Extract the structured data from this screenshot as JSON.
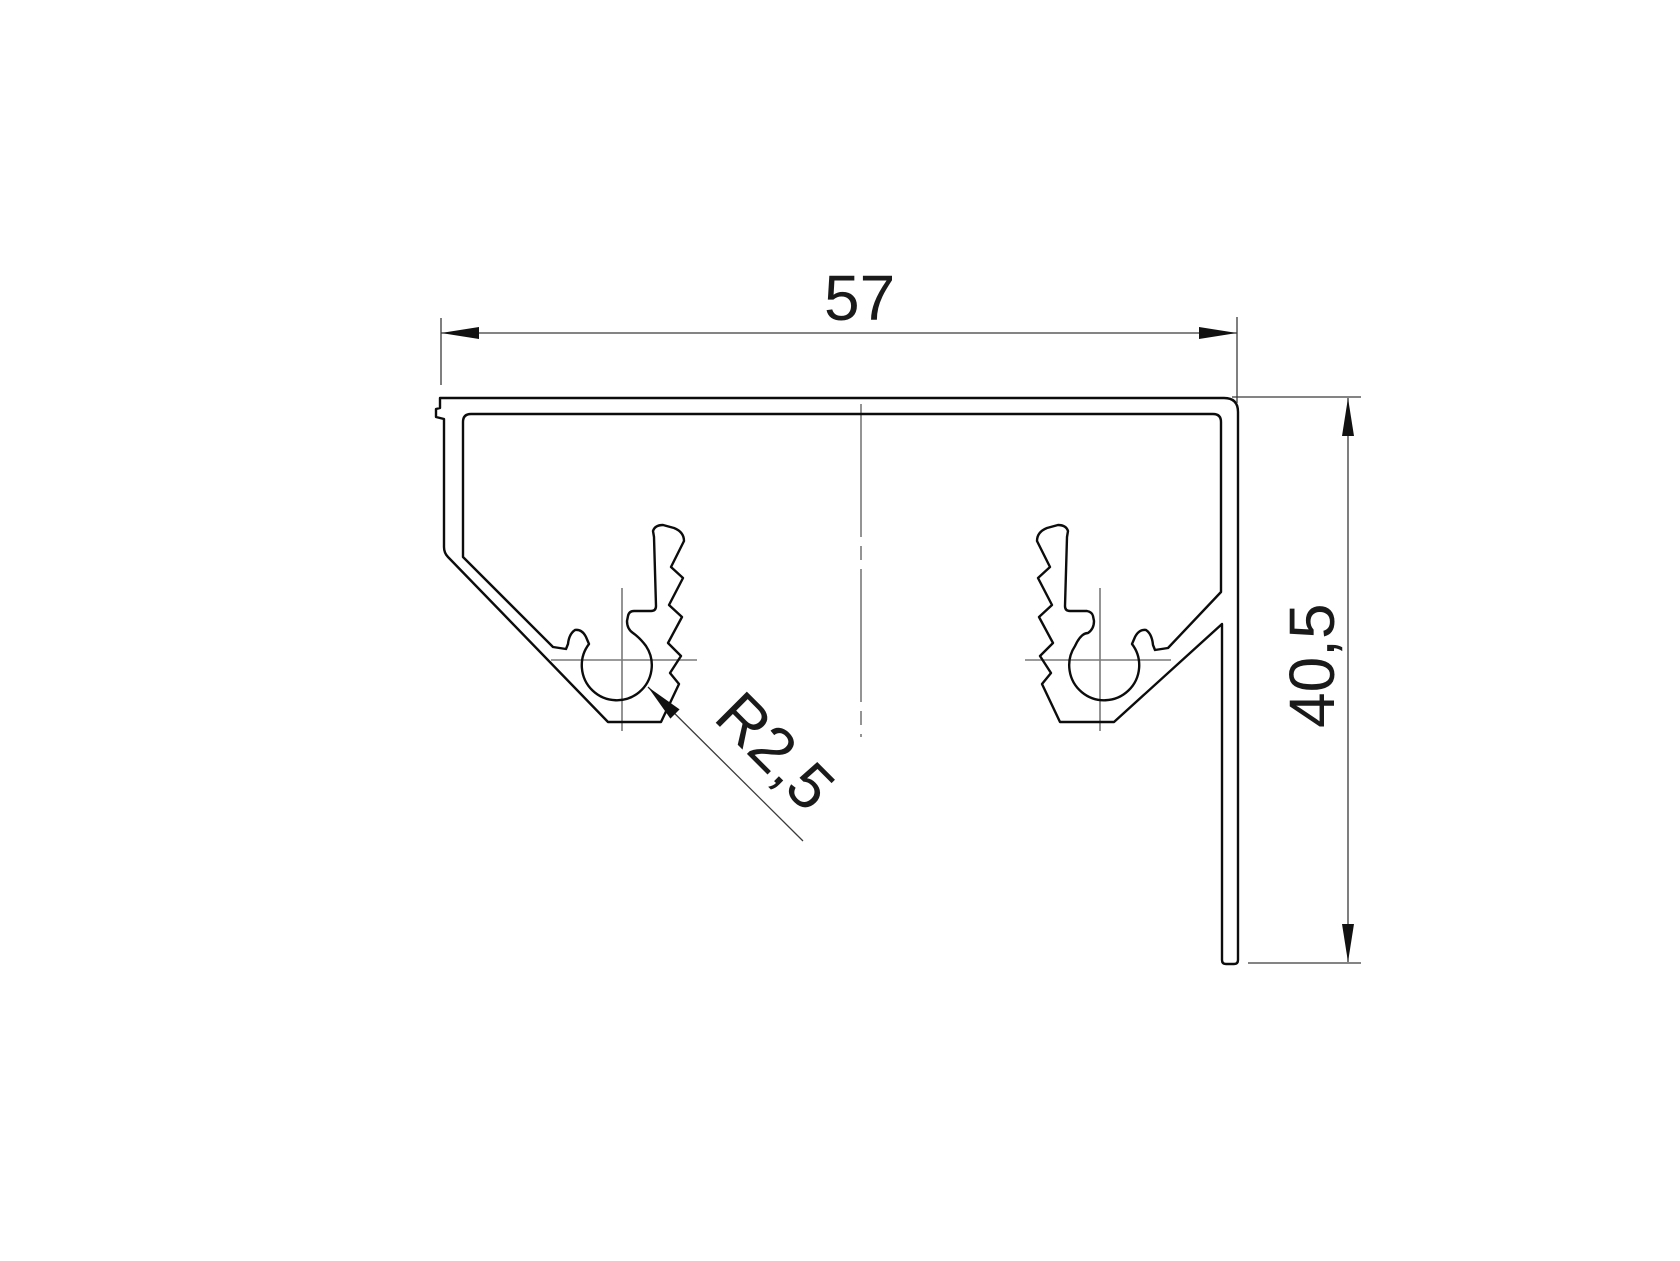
{
  "page": {
    "background": "#ffffff"
  },
  "drawing": {
    "kind": "technical-drawing-cross-section",
    "dimensions": [
      {
        "id": "width",
        "label": "57",
        "orientation": "horizontal"
      },
      {
        "id": "height",
        "label": "40,5",
        "orientation": "vertical"
      },
      {
        "id": "radius",
        "label": "R2,5",
        "orientation": "diagonal-leader"
      }
    ],
    "colors": {
      "outline": "#0c0c0c",
      "dimension": "#3a3a3a",
      "centerline": "#7a7a7a",
      "text": "#1a1a1a",
      "background": "#ffffff"
    }
  }
}
